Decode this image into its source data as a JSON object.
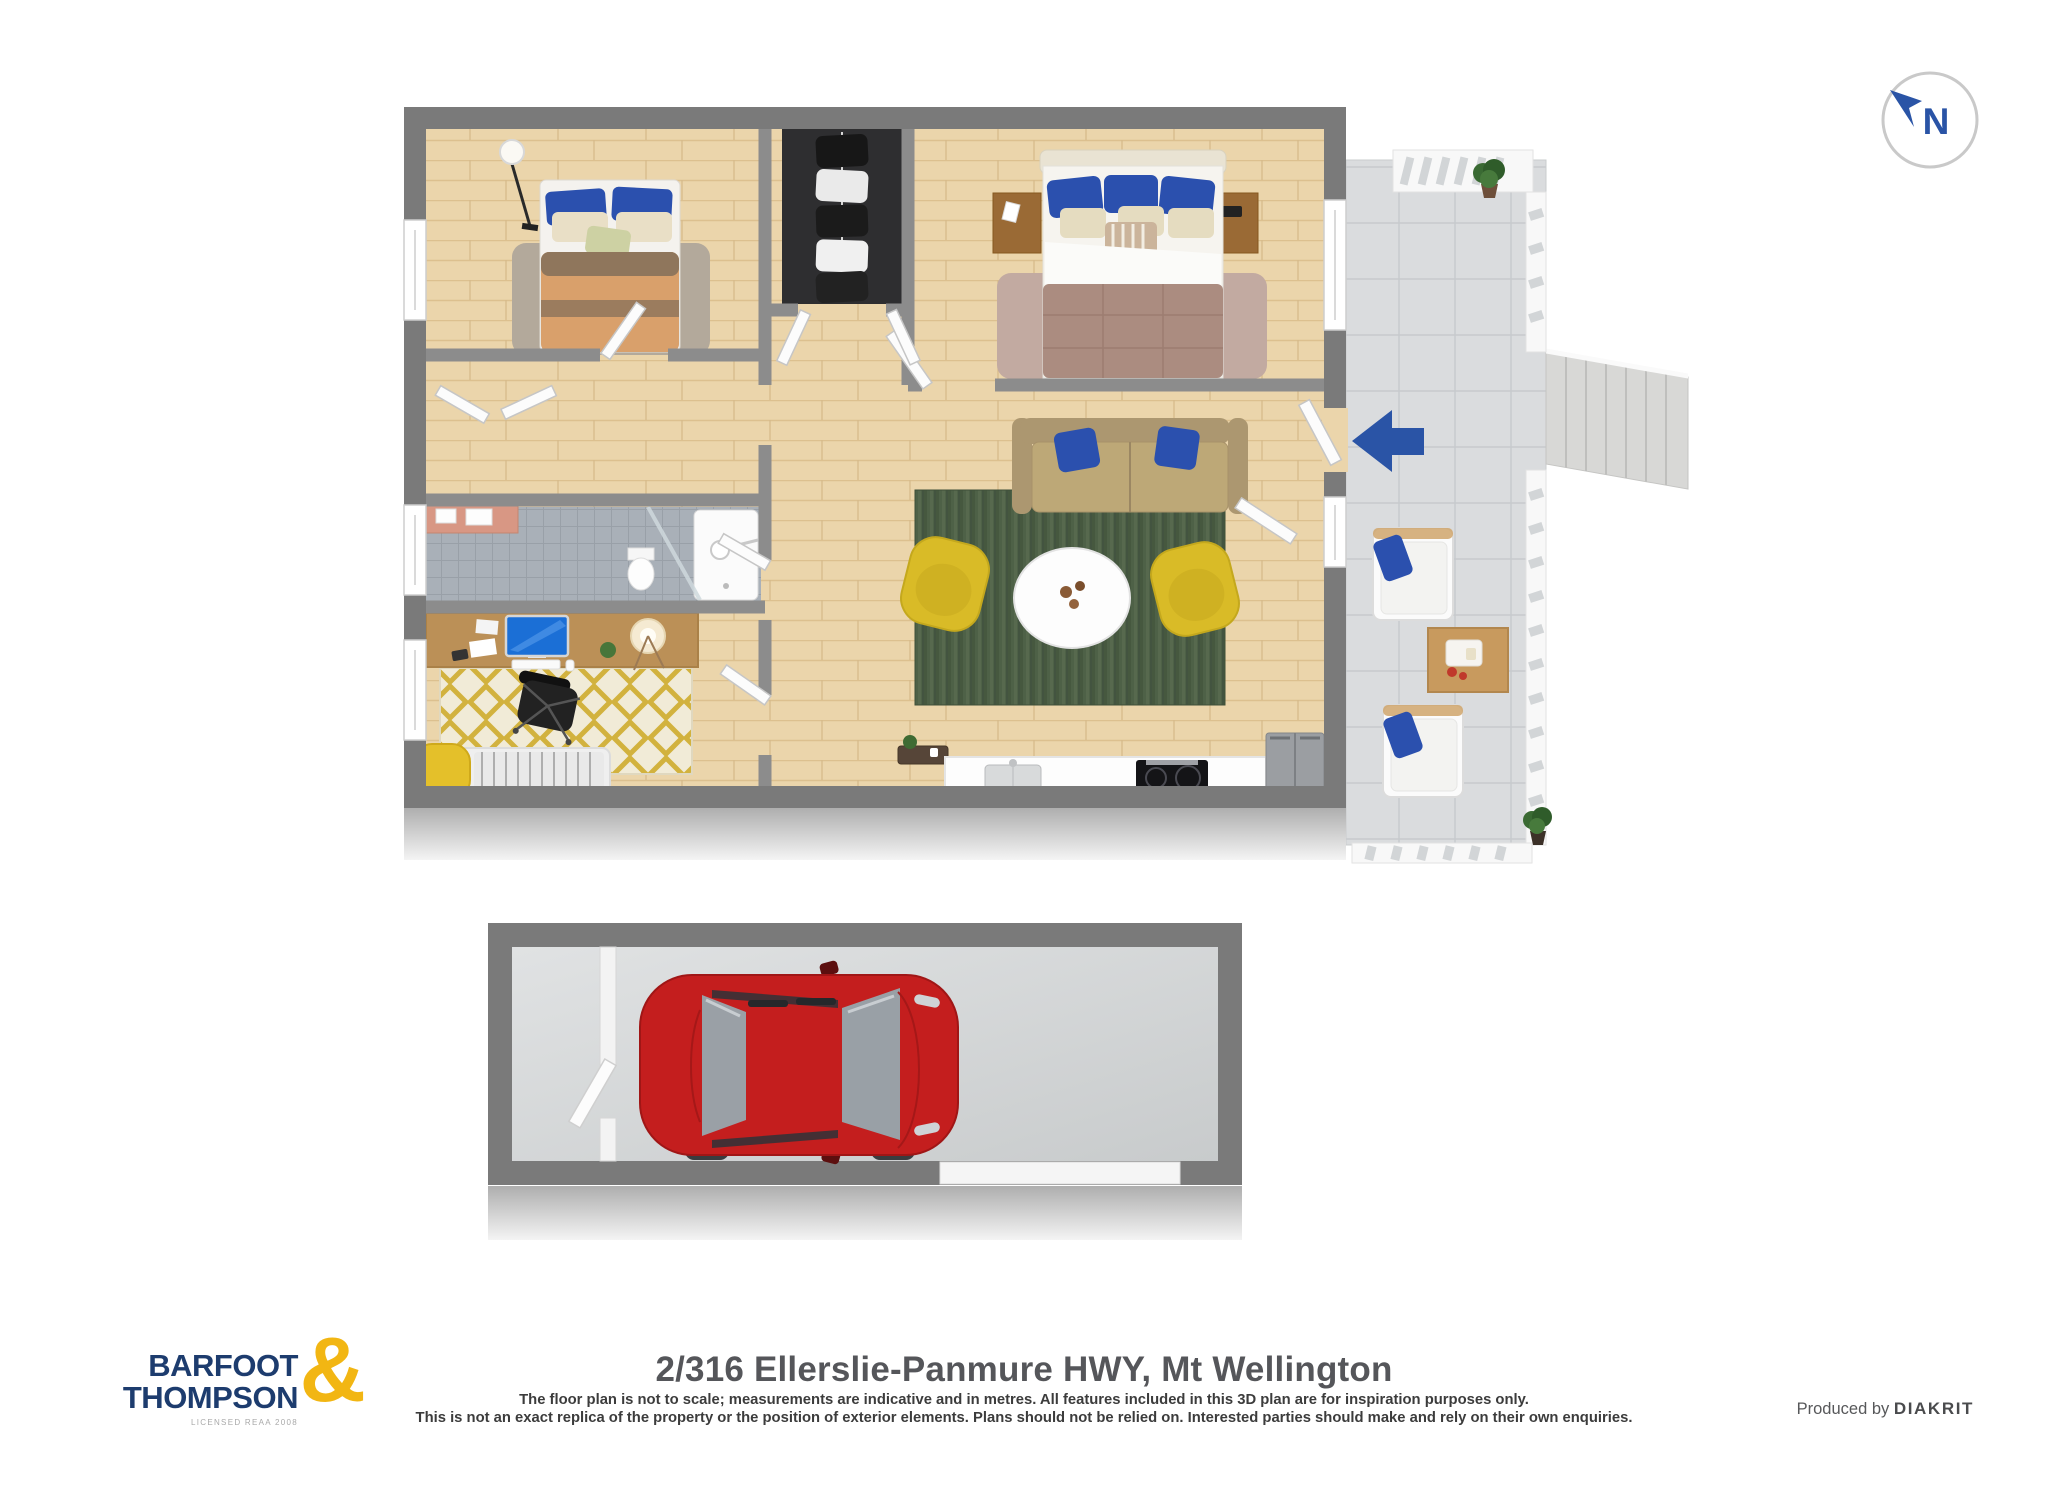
{
  "palette": {
    "accent_blue": "#2a54a6",
    "car_red": "#c41e1e",
    "brand_navy": "#1d3c6e",
    "brand_yellow": "#f2b613",
    "wall_gray": "#7a7a7a",
    "wood_floor": "#ebd5ab",
    "deck_tile": "#dadcde",
    "rug_green": "#4e6147",
    "armchair_yellow": "#d9bb27",
    "bathroom_tile": "#a9b0b8",
    "pillow_blue": "#2b50ae"
  },
  "compass": {
    "label": "N"
  },
  "entrance": {
    "direction": "left"
  },
  "footer": {
    "logo": {
      "line1": "BARFOOT",
      "line2": "THOMPSON",
      "ampersand": "&",
      "tagline": "LICENSED REAA 2008"
    },
    "address": "2/316 Ellerslie-Panmure HWY, Mt Wellington",
    "disclaimer_line1": "The floor plan is not to scale; measurements are indicative and in metres. All features included in this 3D plan are for inspiration purposes only.",
    "disclaimer_line2": "This is not an exact replica of the property or the position of exterior elements. Plans should not be relied on. Interested parties should make and rely on their own enquiries.",
    "produced_by_prefix": "Produced by",
    "produced_by_brand": "DIAKRIT"
  }
}
